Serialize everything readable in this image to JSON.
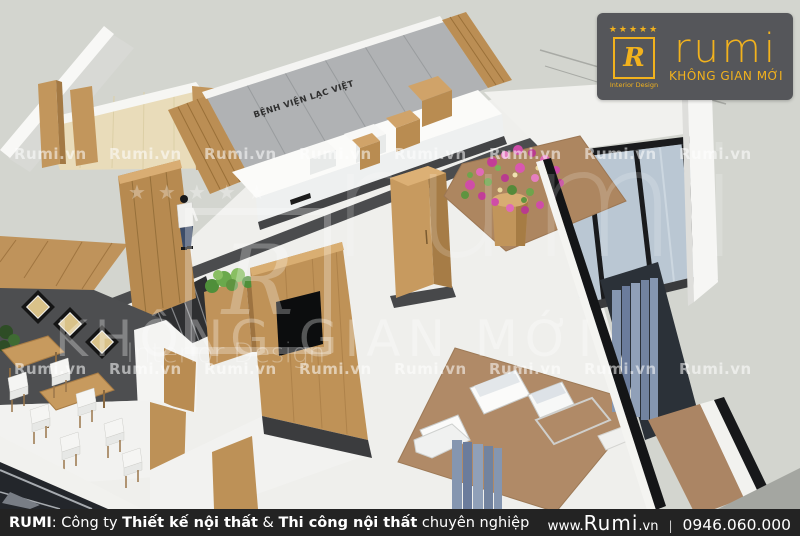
{
  "brand": {
    "stars": "★★★★★",
    "monogram": "R",
    "name": "rumi",
    "tagline": "KHÔNG GIAN MỚI",
    "subtitle": "Interior Design",
    "gold": "#F2B21D",
    "panel_bg": "#55565A"
  },
  "watermark": {
    "text": "Rumi.vn"
  },
  "scene": {
    "sign_text": "BỆNH VIỆN LẠC VIỆT"
  },
  "footer": {
    "company": "RUMI",
    "colon": ": ",
    "seg1": "Công ty ",
    "seg2": "Thiết kế nội thất",
    "amp": " & ",
    "seg3": "Thi công nội thất",
    "seg4": " chuyên nghiệp",
    "www": "www.",
    "domain": "Rumi",
    "tld": ".vn",
    "sep": "|",
    "phone": "0946.060.000",
    "bar_bg": "#232323"
  }
}
